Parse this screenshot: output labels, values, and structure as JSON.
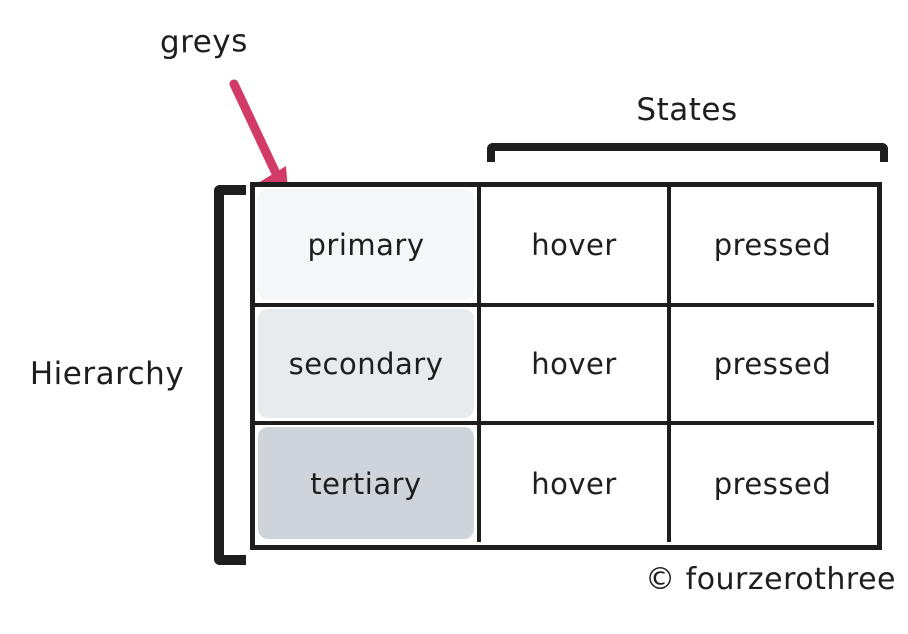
{
  "annotation": {
    "label": "greys",
    "arrow_color": "#d23b67"
  },
  "axes": {
    "columns_group_label": "States",
    "rows_group_label": "Hierarchy"
  },
  "matrix": {
    "rows": [
      {
        "name": "primary",
        "fill": "#f4f6f7",
        "states": [
          "hover",
          "pressed"
        ]
      },
      {
        "name": "secondary",
        "fill": "#e7ebee",
        "states": [
          "hover",
          "pressed"
        ]
      },
      {
        "name": "tertiary",
        "fill": "#cfd4db",
        "states": [
          "hover",
          "pressed"
        ]
      }
    ]
  },
  "colors": {
    "ink": "#1e1e1e",
    "background": "#ffffff",
    "arrow": "#d23b67"
  },
  "footer": {
    "credit": "© fourzerothree"
  }
}
